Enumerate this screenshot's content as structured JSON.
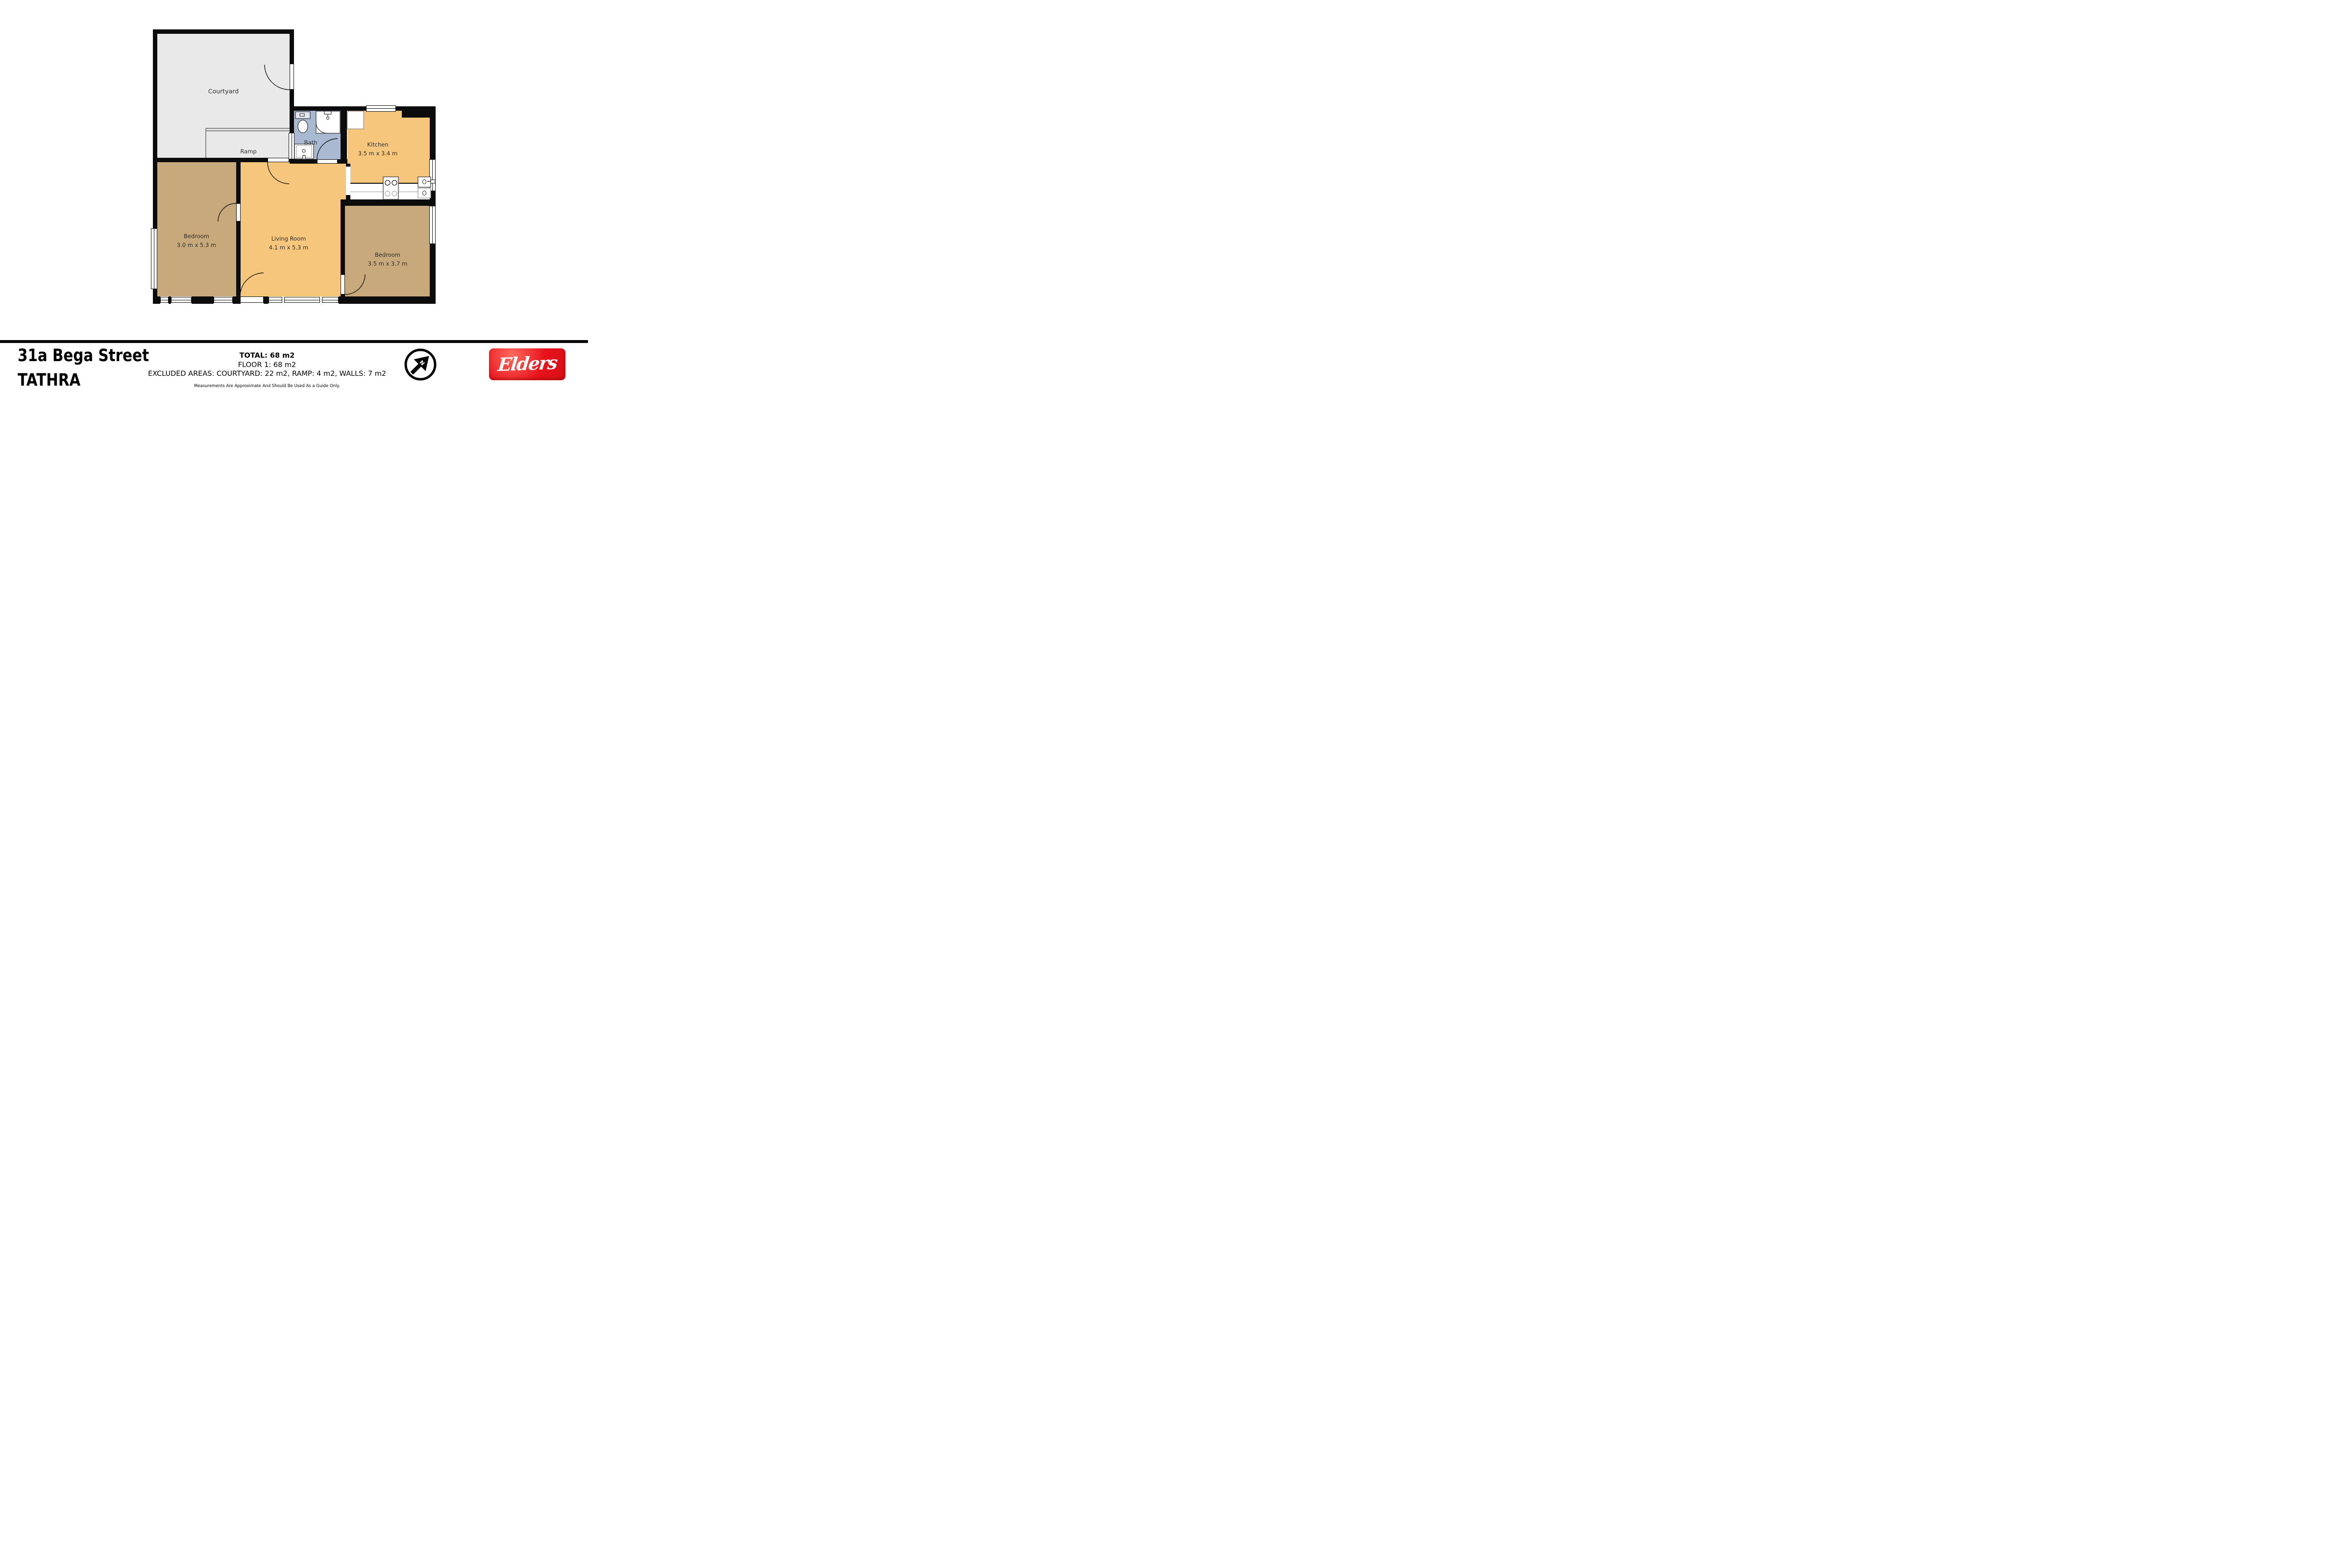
{
  "title": "31a Bega Street TATHRA floor plan",
  "address": {
    "line1": "31a Bega Street",
    "line2": "TATHRA"
  },
  "summary": {
    "total": "TOTAL: 68 m2",
    "floor": "FLOOR 1: 68 m2",
    "excluded": "EXCLUDED AREAS: COURTYARD: 22 m2, RAMP: 4 m2, WALLS: 7 m2",
    "disclaimer": "Measurements Are Approximate And Should Be Used As a Guide Only."
  },
  "rooms": [
    {
      "id": "courtyard",
      "label": "Courtyard",
      "dims": ""
    },
    {
      "id": "ramp",
      "label": "Ramp",
      "dims": ""
    },
    {
      "id": "bath",
      "label": "Bath",
      "dims": ""
    },
    {
      "id": "kitchen",
      "label": "Kitchen",
      "dims": "3.5 m x 3.4 m"
    },
    {
      "id": "bedroom-left",
      "label": "Bedroom",
      "dims": "3.0 m x 5.3 m"
    },
    {
      "id": "living-room",
      "label": "Living Room",
      "dims": "4.1 m x 5.3 m"
    },
    {
      "id": "bedroom-right",
      "label": "Bedroom",
      "dims": "3.5 m x 3.7 m"
    }
  ],
  "branding": {
    "logo_text": "Elders",
    "north_label": "N"
  },
  "colors": {
    "wall": "#0c0c0c",
    "courtyard": "#e9e9e9",
    "bath": "#a9b9d2",
    "kitchen": "#f6c67d",
    "bedroom": "#c7a97b",
    "logo_red": "#e8131c"
  }
}
